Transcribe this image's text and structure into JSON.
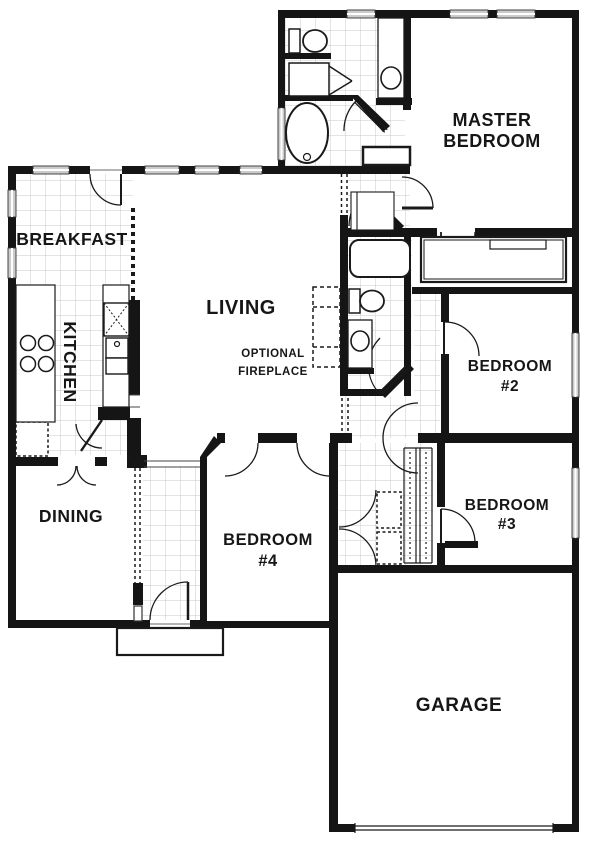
{
  "plan": {
    "rooms": {
      "master": {
        "line1": "MASTER",
        "line2": "BEDROOM"
      },
      "breakfast": {
        "label": "BREAKFAST"
      },
      "kitchen": {
        "label": "KITCHEN"
      },
      "living": {
        "label": "LIVING"
      },
      "fireplace": {
        "line1": "OPTIONAL",
        "line2": "FIREPLACE"
      },
      "dining": {
        "label": "DINING"
      },
      "bedroom2": {
        "line1": "BEDROOM",
        "line2": "#2"
      },
      "bedroom3": {
        "line1": "BEDROOM",
        "line2": "#3"
      },
      "bedroom4": {
        "line1": "BEDROOM",
        "line2": "#4"
      },
      "garage": {
        "label": "GARAGE"
      }
    },
    "colors": {
      "wall": "#151515",
      "line": "#1a1a1a",
      "tile_line": "#c9c9c9",
      "window_fill": "#cccccc"
    }
  }
}
